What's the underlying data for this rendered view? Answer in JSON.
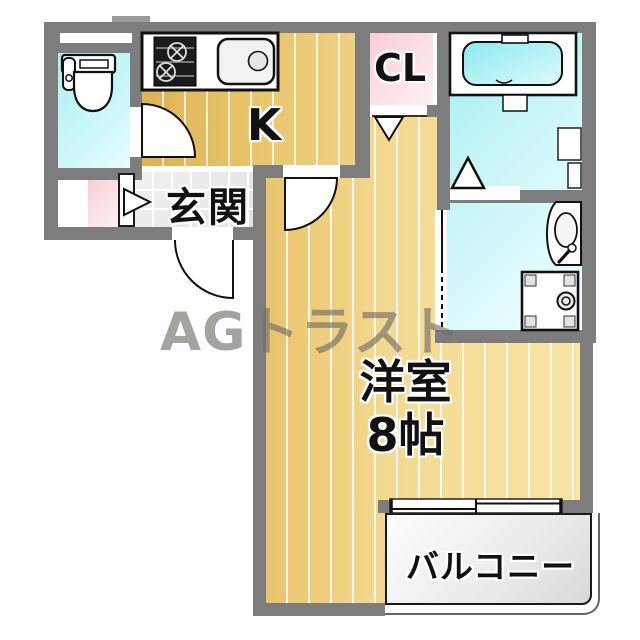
{
  "title": "1K apartment floor plan",
  "rooms": {
    "kitchen": {
      "label": "K"
    },
    "entrance": {
      "label": "玄関"
    },
    "closet": {
      "label": "CL"
    },
    "main": {
      "name": "洋室",
      "size": "8帖"
    },
    "balcony": {
      "label": "バルコニー"
    }
  },
  "watermark": {
    "text": "AGトラスト"
  },
  "fixtures": [
    "toilet",
    "gas-stove",
    "kitchen-sink",
    "bathtub",
    "bath-step",
    "washbasin",
    "washing-machine-pan",
    "sliding-window",
    "hinged-door-toilet",
    "hinged-door-kitchen",
    "hinged-door-entrance",
    "folding-door-closet",
    "folding-door-bath",
    "folding-door-entrance-storage"
  ],
  "colors": {
    "wall": "#7d7d7d",
    "room_floor": "#f3da92",
    "kitchen_floor": "#e9c76e",
    "wet_area": "#9feef1",
    "closet_pink": "#f8cdd6",
    "entrance_tile": "#e9e9e9",
    "balcony": "#e5e5e5",
    "watermark_gray": "#6f6b66"
  }
}
